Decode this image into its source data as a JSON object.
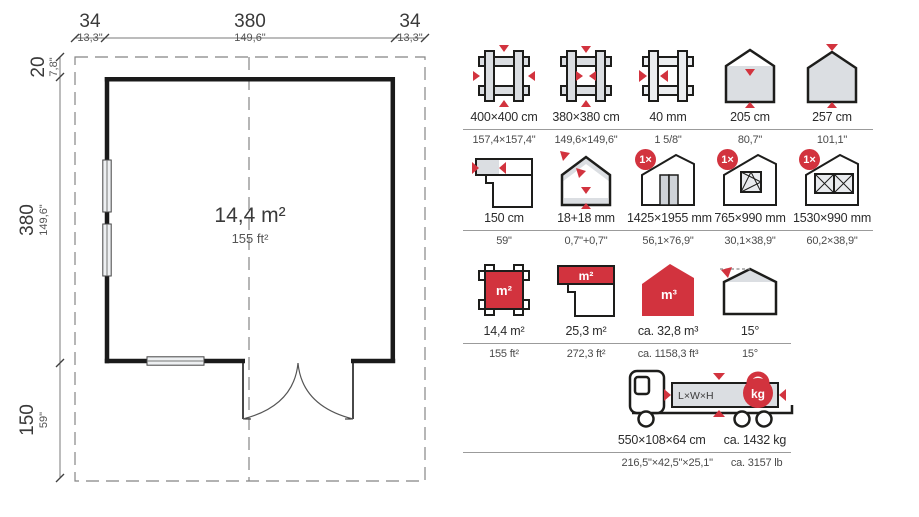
{
  "colors": {
    "red": "#d2333e",
    "icon_fill": "#dbdee2",
    "outline": "#1d1d1b",
    "rule": "#9b9b9b"
  },
  "floor_plan": {
    "area": {
      "metric": "14,4 m²",
      "imperial": "155 ft²"
    },
    "dimensions": {
      "top": [
        {
          "cm": "34",
          "in": "13,3\""
        },
        {
          "cm": "380",
          "in": "149,6\""
        },
        {
          "cm": "34",
          "in": "13,3\""
        }
      ],
      "left": [
        {
          "cm": "20",
          "in": "7,8\""
        },
        {
          "cm": "380",
          "in": "149,6\""
        },
        {
          "cm": "150",
          "in": "59\""
        }
      ]
    }
  },
  "specs": {
    "icon_labels": {
      "x1": "1×",
      "m2": "m²",
      "m3": "m³",
      "kg": "kg",
      "lwh": "L×W×H"
    },
    "rows": [
      {
        "items": [
          {
            "name": "footprint-outer",
            "value": "400×400 cm",
            "imperial": "157,4×157,4\""
          },
          {
            "name": "footprint-inner",
            "value": "380×380 cm",
            "imperial": "149,6×149,6\""
          },
          {
            "name": "wall-thickness",
            "value": "40 mm",
            "imperial": "1 5/8\""
          },
          {
            "name": "wall-height",
            "value": "205 cm",
            "imperial": "80,7\""
          },
          {
            "name": "ridge-height",
            "value": "257 cm",
            "imperial": "101,1\""
          }
        ]
      },
      {
        "items": [
          {
            "name": "terrace-depth",
            "value": "150 cm",
            "imperial": "59\""
          },
          {
            "name": "roof-floor-thickness",
            "value": "18+18 mm",
            "imperial": "0,7\"+0,7\""
          },
          {
            "name": "door",
            "value": "1425×1955 mm",
            "imperial": "56,1×76,9\"",
            "badge": "1×"
          },
          {
            "name": "window-single",
            "value": "765×990 mm",
            "imperial": "30,1×38,9\"",
            "badge": "1×"
          },
          {
            "name": "window-double",
            "value": "1530×990 mm",
            "imperial": "60,2×38,9\"",
            "badge": "1×"
          }
        ]
      },
      {
        "items": [
          {
            "name": "floor-area",
            "value": "14,4 m²",
            "imperial": "155 ft²"
          },
          {
            "name": "terrace-area",
            "value": "25,3 m²",
            "imperial": "272,3 ft²"
          },
          {
            "name": "volume",
            "value": "ca. 32,8 m³",
            "imperial": "ca. 1158,3 ft³"
          },
          {
            "name": "roof-pitch",
            "value": "15°",
            "imperial": "15°"
          }
        ]
      }
    ],
    "transport": {
      "values": [
        "550×108×64 cm",
        "ca. 1432 kg"
      ],
      "imperial": [
        "216,5\"×42,5\"×25,1\"",
        "ca. 3157 lb"
      ]
    }
  }
}
